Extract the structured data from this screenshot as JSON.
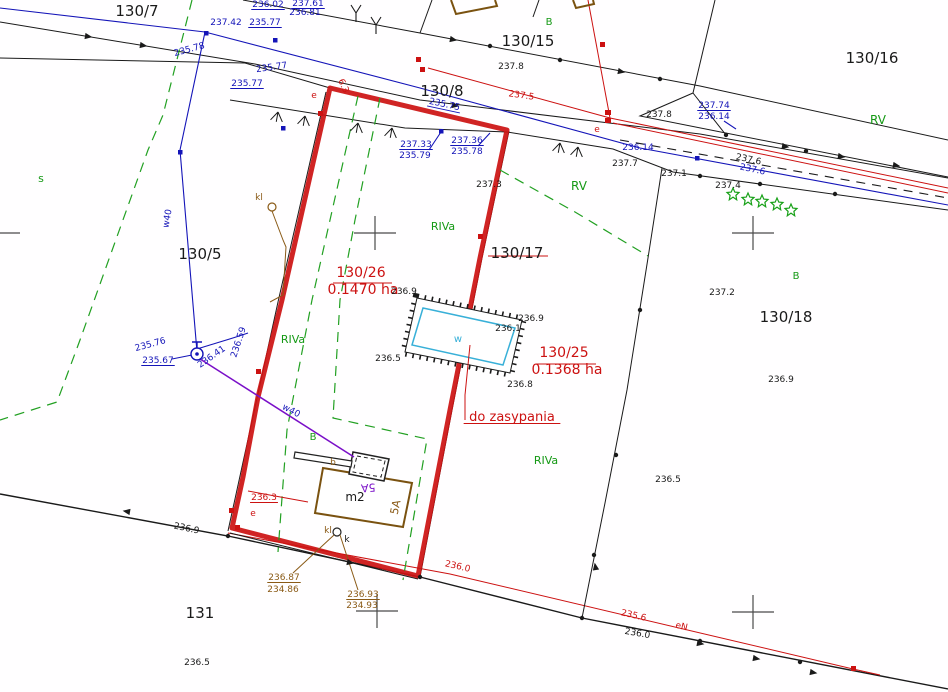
{
  "map": {
    "kind": "cadastral-survey-map",
    "surveyed_parcel_outline_color": "#cc1111",
    "note": "do zasypania"
  },
  "colors": {
    "k": "#1a1a1a",
    "r": "#cc1111",
    "b": "#1414b8",
    "g": "#159915",
    "n": "#8a5a16",
    "p": "#7a0fc8",
    "c": "#38b0d8",
    "x": "#555555"
  },
  "parcels": [
    "130/7",
    "130/15",
    "130/16",
    "130/8",
    "130/5",
    "130/17",
    "130/18",
    "131"
  ],
  "parcel_areas": [
    {
      "parcel": "130/26",
      "area": "0.1470 ha"
    },
    {
      "parcel": "130/25",
      "area": "0.1368 ha"
    }
  ],
  "soil_use_classes": [
    "RIVa",
    "RV",
    "B",
    "s"
  ],
  "labels": [
    {
      "name": "parcel-number-130-7",
      "text": "130/7",
      "x": 137,
      "y": 16,
      "c": "k",
      "s": 15
    },
    {
      "name": "parcel-number-130-15",
      "text": "130/15",
      "x": 528,
      "y": 46,
      "c": "k",
      "s": 15
    },
    {
      "name": "parcel-number-130-16",
      "text": "130/16",
      "x": 872,
      "y": 63,
      "c": "k",
      "s": 15
    },
    {
      "name": "parcel-number-130-8",
      "text": "130/8",
      "x": 442,
      "y": 96,
      "c": "k",
      "s": 15
    },
    {
      "name": "parcel-number-130-5",
      "text": "130/5",
      "x": 200,
      "y": 259,
      "c": "k",
      "s": 15
    },
    {
      "name": "parcel-number-130-17",
      "text": "130/17",
      "x": 517,
      "y": 258,
      "c": "k",
      "s": 15
    },
    {
      "name": "parcel-number-130-18",
      "text": "130/18",
      "x": 786,
      "y": 322,
      "c": "k",
      "s": 15
    },
    {
      "name": "parcel-number-131",
      "text": "131",
      "x": 200,
      "y": 618,
      "c": "k",
      "s": 15
    },
    {
      "name": "area-number-130-26",
      "text": "130/26",
      "x": 361,
      "y": 277,
      "c": "r",
      "s": 14
    },
    {
      "name": "area-size-130-26",
      "text": "0.1470 ha",
      "x": 363,
      "y": 294,
      "c": "r",
      "s": 14
    },
    {
      "name": "area-number-130-25",
      "text": "130/25",
      "x": 564,
      "y": 357,
      "c": "r",
      "s": 14
    },
    {
      "name": "area-size-130-25",
      "text": "0.1368 ha",
      "x": 567,
      "y": 374,
      "c": "r",
      "s": 14
    },
    {
      "name": "note-do-zasypania",
      "text": "do zasypania",
      "x": 512,
      "y": 421,
      "c": "r",
      "s": 13,
      "ul": true
    },
    {
      "name": "elev-red-236-3",
      "text": "236.3",
      "x": 264,
      "y": 500,
      "c": "r",
      "s": 9,
      "ul": true
    },
    {
      "name": "elev-red-236-0",
      "text": "236.0",
      "x": 457,
      "y": 569,
      "c": "r",
      "s": 9,
      "rot": 13
    },
    {
      "name": "elev-red-235-6",
      "text": "235.6",
      "x": 633,
      "y": 618,
      "c": "r",
      "s": 9,
      "rot": 13
    },
    {
      "name": "dim-6-3",
      "text": "6.3",
      "x": 341,
      "y": 87,
      "c": "r",
      "s": 9,
      "rot": 65
    },
    {
      "name": "elev-red-237-5",
      "text": "237.5",
      "x": 521,
      "y": 98,
      "c": "r",
      "s": 9,
      "rot": 8
    },
    {
      "name": "elev-237-3",
      "text": "237.3",
      "x": 489,
      "y": 187,
      "c": "k",
      "s": 9
    },
    {
      "name": "power-mark-e-1",
      "text": "e",
      "x": 314,
      "y": 98,
      "c": "r",
      "s": 9
    },
    {
      "name": "power-mark-e-2",
      "text": "e",
      "x": 597,
      "y": 132,
      "c": "r",
      "s": 9
    },
    {
      "name": "power-mark-e-3",
      "text": "e",
      "x": 253,
      "y": 516,
      "c": "r",
      "s": 9
    },
    {
      "name": "power-mark-eN",
      "text": "eN",
      "x": 681,
      "y": 629,
      "c": "r",
      "s": 9,
      "rot": 13
    },
    {
      "name": "elev-blue-235-75",
      "text": "235.75",
      "x": 444,
      "y": 107,
      "c": "b",
      "s": 9,
      "rot": 12,
      "ul": true
    },
    {
      "name": "elev-blue-236-02",
      "text": "236.02",
      "x": 268,
      "y": 7,
      "c": "b",
      "s": 9,
      "ul": true
    },
    {
      "name": "elev-blue-237-61",
      "text": "237.61",
      "x": 308,
      "y": 6,
      "c": "b",
      "s": 9,
      "ul": true
    },
    {
      "name": "elev-blue-236-81",
      "text": "236.81",
      "x": 305,
      "y": 15,
      "c": "b",
      "s": 9
    },
    {
      "name": "elev-blue-235-77a",
      "text": "235.77",
      "x": 265,
      "y": 25,
      "c": "b",
      "s": 9,
      "ul": true
    },
    {
      "name": "elev-blue-237-42",
      "text": "237.42",
      "x": 226,
      "y": 25,
      "c": "b",
      "s": 9
    },
    {
      "name": "elev-blue-235-78a",
      "text": "235.78",
      "x": 190,
      "y": 52,
      "c": "b",
      "s": 9,
      "rot": -15
    },
    {
      "name": "elev-blue-235-77b",
      "text": "235.77",
      "x": 272,
      "y": 70,
      "c": "b",
      "s": 9,
      "rot": -8
    },
    {
      "name": "elev-blue-235-77c",
      "text": "235.77",
      "x": 247,
      "y": 86,
      "c": "b",
      "s": 9,
      "ul": true
    },
    {
      "name": "elev-blue-237-33",
      "text": "237.33",
      "x": 416,
      "y": 147,
      "c": "b",
      "s": 9,
      "ul": true
    },
    {
      "name": "elev-blue-235-79",
      "text": "235.79",
      "x": 415,
      "y": 158,
      "c": "b",
      "s": 9
    },
    {
      "name": "elev-blue-237-36",
      "text": "237.36",
      "x": 467,
      "y": 143,
      "c": "b",
      "s": 9,
      "ul": true
    },
    {
      "name": "elev-blue-235-78b",
      "text": "235.78",
      "x": 467,
      "y": 154,
      "c": "b",
      "s": 9
    },
    {
      "name": "elev-blue-237-74",
      "text": "237.74",
      "x": 714,
      "y": 108,
      "c": "b",
      "s": 9,
      "ul": true
    },
    {
      "name": "elev-blue-236-14a",
      "text": "236.14",
      "x": 714,
      "y": 119,
      "c": "b",
      "s": 9
    },
    {
      "name": "elev-blue-236-14b",
      "text": "236.14",
      "x": 638,
      "y": 150,
      "c": "b",
      "s": 9
    },
    {
      "name": "elev-blue-237-6",
      "text": "237.6",
      "x": 752,
      "y": 172,
      "c": "b",
      "s": 9,
      "rot": 12
    },
    {
      "name": "elev-blue-235-76",
      "text": "235.76",
      "x": 151,
      "y": 347,
      "c": "b",
      "s": 9,
      "rot": -15
    },
    {
      "name": "elev-blue-235-67",
      "text": "235.67",
      "x": 158,
      "y": 363,
      "c": "b",
      "s": 9,
      "ul": true
    },
    {
      "name": "elev-blue-236-59",
      "text": "236.59",
      "x": 241,
      "y": 343,
      "c": "b",
      "s": 9,
      "rot": -72
    },
    {
      "name": "elev-blue-236-41",
      "text": "236.41",
      "x": 213,
      "y": 359,
      "c": "b",
      "s": 9,
      "rot": -35
    },
    {
      "name": "pipe-w40-a",
      "text": "w40",
      "x": 170,
      "y": 219,
      "c": "b",
      "s": 9,
      "rot": -80
    },
    {
      "name": "pipe-w40-b",
      "text": "w40",
      "x": 290,
      "y": 413,
      "c": "b",
      "s": 9,
      "rot": 28
    },
    {
      "name": "elev-237-8a",
      "text": "237.8",
      "x": 511,
      "y": 69,
      "c": "k",
      "s": 9
    },
    {
      "name": "elev-237-8b",
      "text": "237.8",
      "x": 659,
      "y": 117,
      "c": "k",
      "s": 9
    },
    {
      "name": "elev-237-7",
      "text": "237.7",
      "x": 625,
      "y": 166,
      "c": "k",
      "s": 9
    },
    {
      "name": "elev-237-1",
      "text": "237.1",
      "x": 674,
      "y": 176,
      "c": "k",
      "s": 9
    },
    {
      "name": "elev-237-6k",
      "text": "237.6",
      "x": 748,
      "y": 162,
      "c": "k",
      "s": 9,
      "rot": 12
    },
    {
      "name": "elev-237-4",
      "text": "237.4",
      "x": 728,
      "y": 188,
      "c": "k",
      "s": 9
    },
    {
      "name": "elev-237-2",
      "text": "237.2",
      "x": 722,
      "y": 295,
      "c": "k",
      "s": 9
    },
    {
      "name": "elev-236-9a",
      "text": "236.9",
      "x": 781,
      "y": 382,
      "c": "k",
      "s": 9
    },
    {
      "name": "elev-236-5a",
      "text": "236.5",
      "x": 668,
      "y": 482,
      "c": "k",
      "s": 9
    },
    {
      "name": "elev-236-9-pit-tl",
      "text": "236.9",
      "x": 404,
      "y": 294,
      "c": "k",
      "s": 9
    },
    {
      "name": "elev-236-9-pit-tr",
      "text": "236.9",
      "x": 531,
      "y": 321,
      "c": "k",
      "s": 9
    },
    {
      "name": "elev-236-1-pit",
      "text": "236.1",
      "x": 508,
      "y": 331,
      "c": "k",
      "s": 9
    },
    {
      "name": "elev-236-5-pit",
      "text": "236.5",
      "x": 388,
      "y": 361,
      "c": "k",
      "s": 9
    },
    {
      "name": "elev-236-8-pit",
      "text": "236.8",
      "x": 520,
      "y": 387,
      "c": "k",
      "s": 9
    },
    {
      "name": "elev-236-9-south",
      "text": "236.9",
      "x": 186,
      "y": 531,
      "c": "k",
      "s": 9,
      "rot": 12
    },
    {
      "name": "elev-236-0-south",
      "text": "236.0",
      "x": 637,
      "y": 636,
      "c": "k",
      "s": 9,
      "rot": 10
    },
    {
      "name": "elev-236-5-bottom",
      "text": "236.5",
      "x": 197,
      "y": 665,
      "c": "k",
      "s": 9
    },
    {
      "name": "building-label-m2",
      "text": "m2",
      "x": 355,
      "y": 501,
      "c": "k",
      "s": 12
    },
    {
      "name": "mark-k",
      "text": "k",
      "x": 347,
      "y": 542,
      "c": "k",
      "s": 9
    },
    {
      "name": "elev-brown-236-87",
      "text": "236.87",
      "x": 284,
      "y": 580,
      "c": "n",
      "s": 9,
      "ul": true
    },
    {
      "name": "elev-brown-234-86",
      "text": "234.86",
      "x": 283,
      "y": 592,
      "c": "n",
      "s": 9
    },
    {
      "name": "elev-brown-236-93",
      "text": "236.93",
      "x": 363,
      "y": 597,
      "c": "n",
      "s": 9,
      "ul": true
    },
    {
      "name": "elev-brown-234-93",
      "text": "234.93",
      "x": 362,
      "y": 608,
      "c": "n",
      "s": 9
    },
    {
      "name": "mark-kl-a",
      "text": "kl",
      "x": 259,
      "y": 200,
      "c": "n",
      "s": 9
    },
    {
      "name": "mark-kl-b",
      "text": "kl",
      "x": 328,
      "y": 533,
      "c": "n",
      "s": 9
    },
    {
      "name": "mark-b",
      "text": "b",
      "x": 333,
      "y": 465,
      "c": "n",
      "s": 9
    },
    {
      "name": "building-number-5A-brown",
      "text": "5A",
      "x": 399,
      "y": 508,
      "c": "n",
      "s": 11,
      "rot": -78
    },
    {
      "name": "building-number-5A-purple",
      "text": "5A",
      "x": 368,
      "y": 484,
      "c": "p",
      "s": 11,
      "rot": 176
    },
    {
      "name": "soil-B-1",
      "text": "B",
      "x": 549,
      "y": 25,
      "c": "g",
      "s": 10
    },
    {
      "name": "soil-s",
      "text": "s",
      "x": 41,
      "y": 182,
      "c": "g",
      "s": 11
    },
    {
      "name": "soil-B-2",
      "text": "B",
      "x": 313,
      "y": 440,
      "c": "g",
      "s": 10
    },
    {
      "name": "soil-B-3",
      "text": "B",
      "x": 796,
      "y": 279,
      "c": "g",
      "s": 10
    },
    {
      "name": "soil-RV-1",
      "text": "RV",
      "x": 579,
      "y": 190,
      "c": "g",
      "s": 12
    },
    {
      "name": "soil-RV-2",
      "text": "RV",
      "x": 878,
      "y": 124,
      "c": "g",
      "s": 12
    },
    {
      "name": "soil-RIVa-1",
      "text": "RIVa",
      "x": 443,
      "y": 230,
      "c": "g",
      "s": 11
    },
    {
      "name": "soil-RIVa-2",
      "text": "RIVa",
      "x": 293,
      "y": 343,
      "c": "g",
      "s": 11
    },
    {
      "name": "soil-RIVa-3",
      "text": "RIVa",
      "x": 546,
      "y": 464,
      "c": "g",
      "s": 11
    },
    {
      "name": "water-mark-w",
      "text": "w",
      "x": 458,
      "y": 342,
      "c": "c",
      "s": 10
    }
  ]
}
